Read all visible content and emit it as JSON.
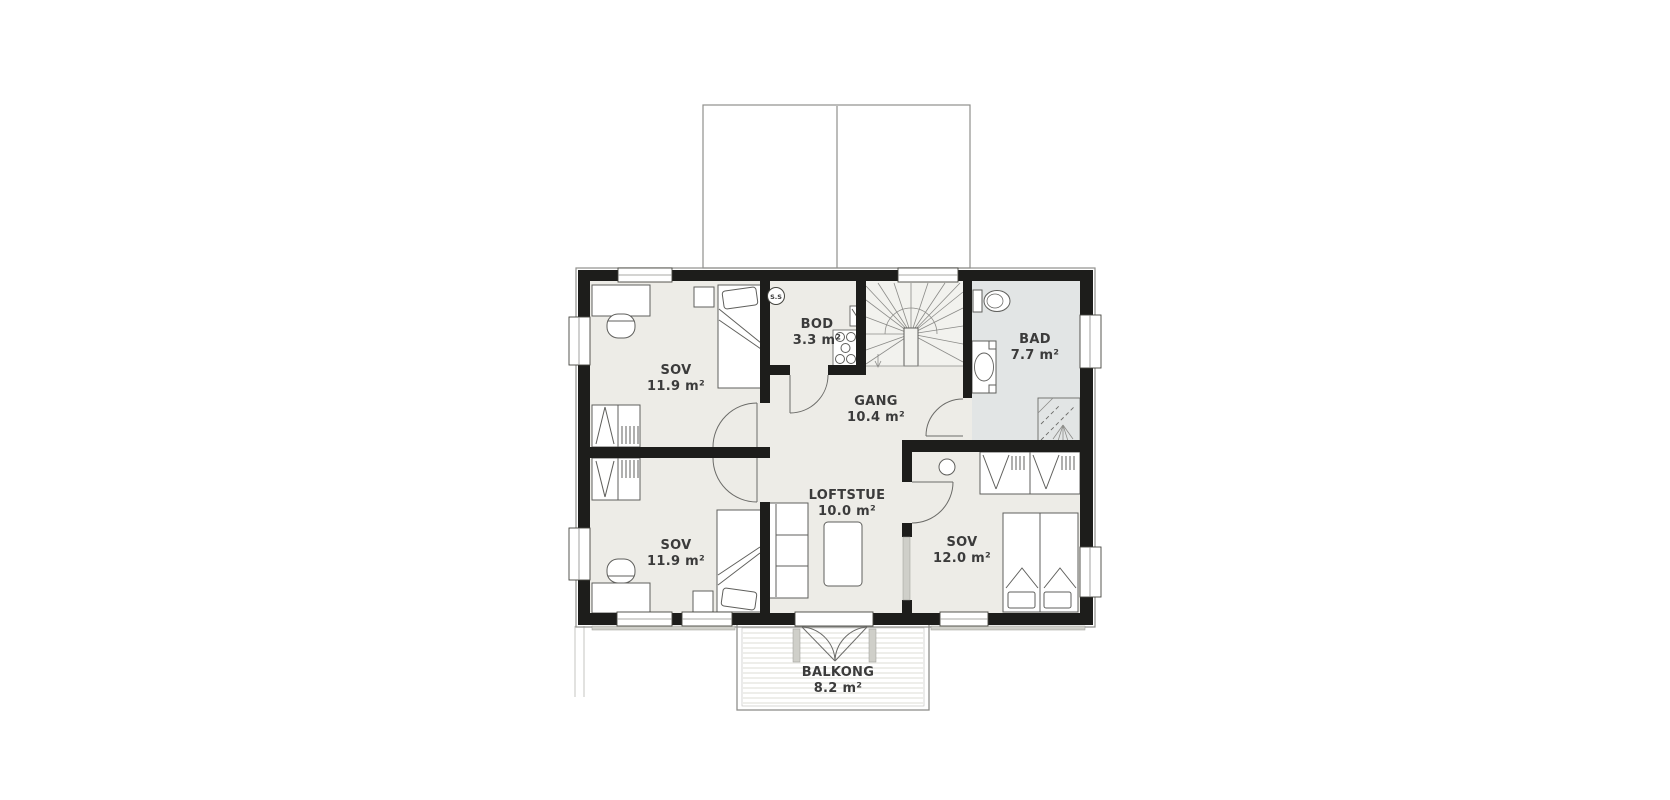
{
  "plan": {
    "marker": "S.S",
    "rooms": [
      {
        "name": "SOV",
        "area": "11.9 m²"
      },
      {
        "name": "BOD",
        "area": "3.3 m²"
      },
      {
        "name": "GANG",
        "area": "10.4 m²"
      },
      {
        "name": "BAD",
        "area": "7.7 m²"
      },
      {
        "name": "SOV",
        "area": "11.9 m²"
      },
      {
        "name": "LOFTSTUE",
        "area": "10.0 m²"
      },
      {
        "name": "SOV",
        "area": "12.0 m²"
      },
      {
        "name": "BALKONG",
        "area": "8.2 m²"
      }
    ],
    "colors": {
      "wall": "#1d1d1b",
      "room_floor": "#edece7",
      "bath_floor": "#e2e5e5",
      "stair_floor": "#f2f2ee",
      "label_text": "#3b3b3b"
    }
  }
}
